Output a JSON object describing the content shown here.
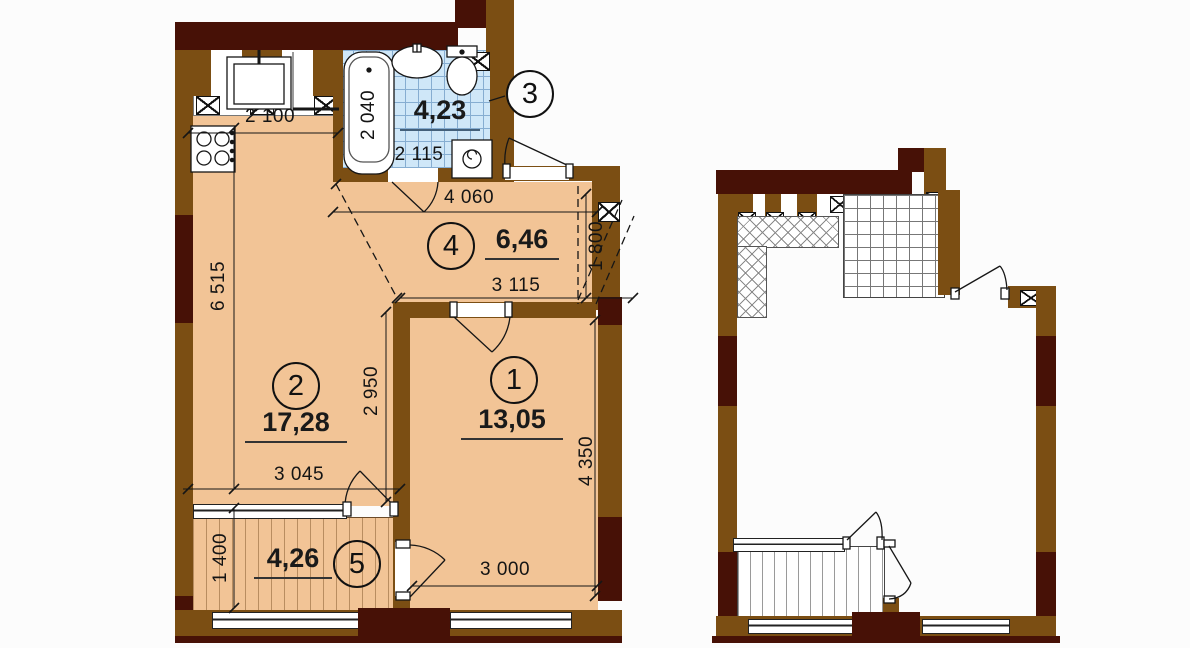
{
  "title": "Apartment floor plan with area schedule",
  "palette": {
    "wall": "#7b4e13",
    "wall_dark": "#471106",
    "floor": "#f2c496",
    "tile": "#cfe7f8",
    "tile_line": "#86add1",
    "ink": "#111111"
  },
  "main_plan": {
    "rooms": [
      {
        "number": "1",
        "area": "13,05"
      },
      {
        "number": "2",
        "area": "17,28"
      },
      {
        "number": "3",
        "area": "4,23"
      },
      {
        "number": "4",
        "area": "6,46"
      },
      {
        "number": "5",
        "area": "4,26"
      }
    ],
    "dimensions": {
      "kitchen_width": "2 100",
      "bath_depth": "2 040",
      "bath_width": "2 115",
      "hall_width_top": "4 060",
      "hall_width_bottom": "3 115",
      "hall_niche_depth": "1 800",
      "left_side_height": "6 515",
      "room2_depth": "2 950",
      "room2_width": "3 045",
      "room1_depth": "4 350",
      "balcony_depth": "1 400",
      "room1_width": "3 000"
    }
  }
}
